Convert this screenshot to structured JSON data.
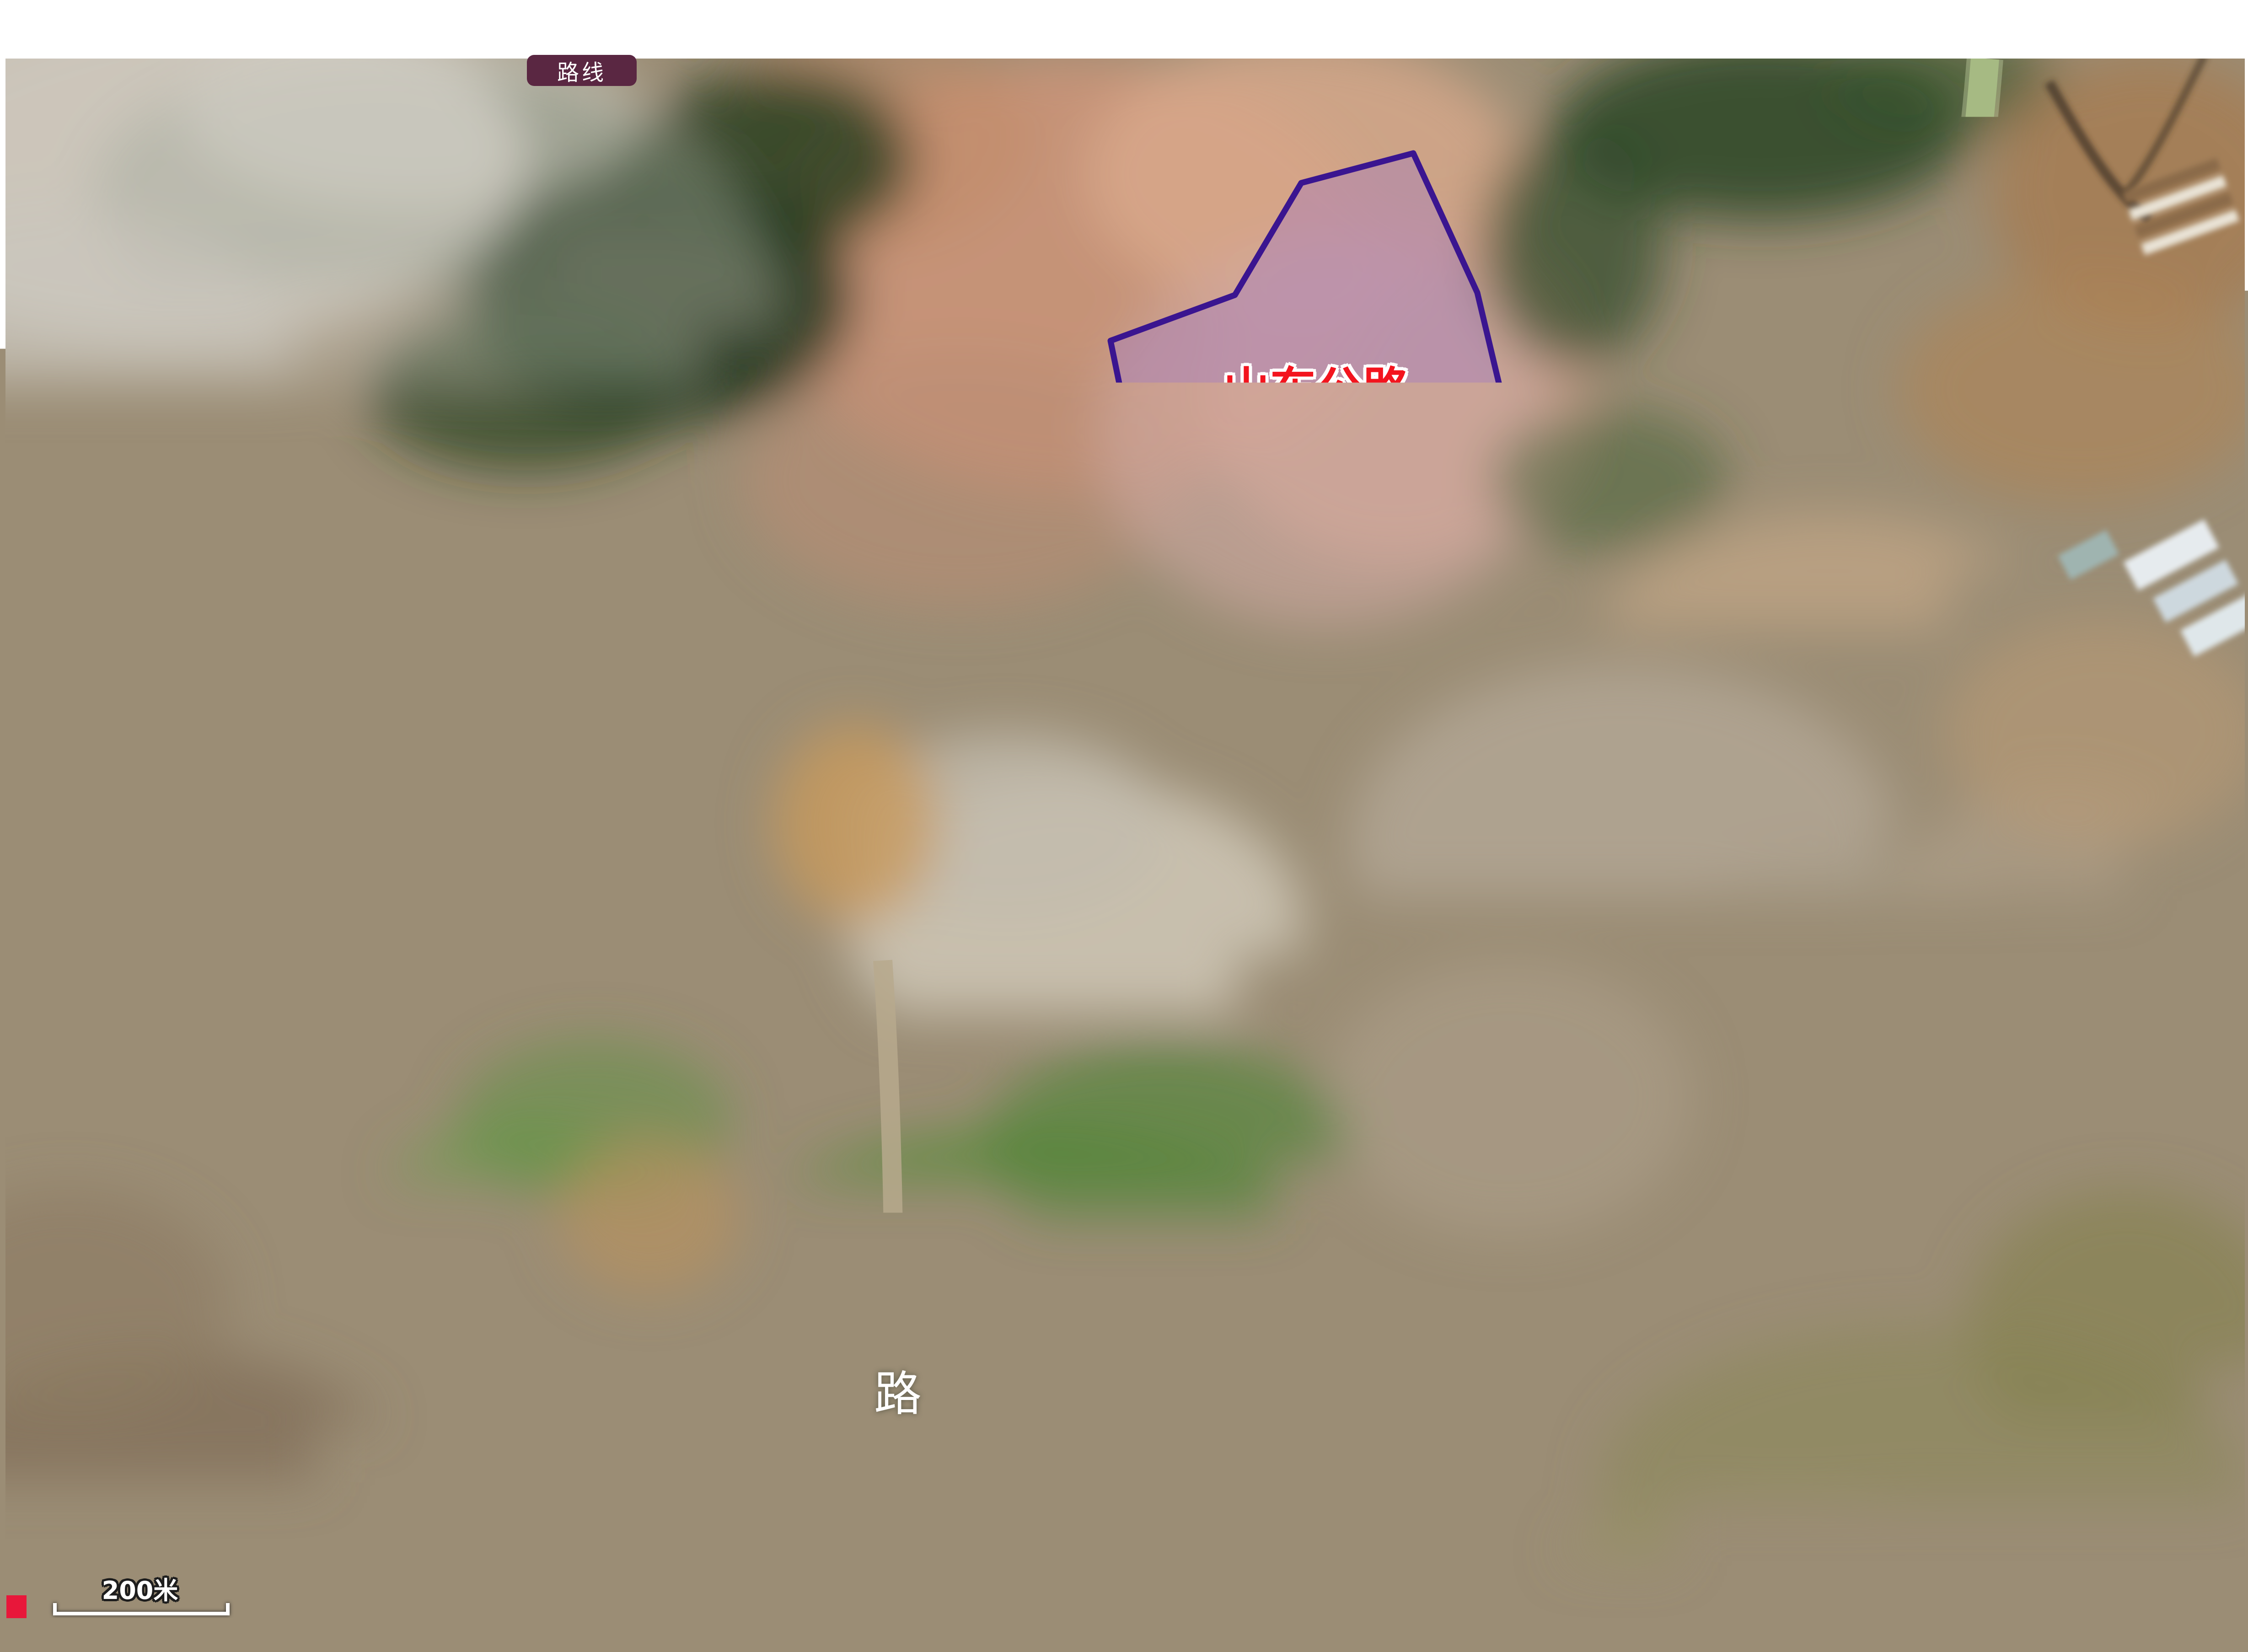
{
  "toolbar": {
    "route_button_label": "路线"
  },
  "labels": {
    "jishi_line1": "山东公路",
    "jishi_line2": "技师学院",
    "xinhang_line1": "山东新航实验",
    "xinhang_line2": "外国语学校",
    "guanliju_line1": "历城区公路管理局",
    "guanliju_line2": "彩石公路管理站",
    "qinghe": "清河太夫人墓",
    "yiliao": "医疗器械创新和监管服务大平台",
    "shipin": "食品药品创新和监管服务大平台"
  },
  "roads": {
    "jingshidong": [
      "经",
      "十",
      "东",
      "路"
    ],
    "cailong": [
      "彩",
      "龙",
      "路"
    ]
  },
  "scale": {
    "label": "200米"
  },
  "colors": {
    "annotation_red": "#f50f1e",
    "annotation_yellow": "#f2d50a",
    "annotation_purple": "#3a1590",
    "purple_fill": "rgba(160,120,195,0.40)",
    "yellow_fill": "rgba(235,185,50,0.42)",
    "red_text": "#f3141e",
    "white_text": "#ffffff",
    "route_button_bg": "#5a2742"
  },
  "polygons": {
    "xinhang": "30,1195 345,1118 410,1228 880,1452 862,1630 795,1780 638,1975 350,1930 90,1820 28,1590",
    "jishi": "3090,335 2845,400 2700,645 2428,745 2468,940 2575,1160 2650,1505 3012,1348 3348,1135 3230,640",
    "guanlizhan": "1728,1608 2040,1532 1992,1902 1798,2060 1692,1958",
    "qinghe": "1250,2526 1580,2494 1594,2788 1262,2836",
    "yiliao_parcel": "1235,2330 1392,2282 1572,2218 1800,2135 1930,2088 1968,2112 1960,2445 1700,2488 1450,2512 1255,2515",
    "small_parcel": "1602,2568 1948,2505 1956,2618 1788,2624 1788,2836 1602,2840",
    "shipin_parcel": "2758,1975 2998,2210 2880,2398 2758,2575 2600,2690 2442,2738 2350,2735 2390,2392"
  },
  "lines": {
    "yiliao_leader": "225,3052 1790,3052 1790,2838",
    "shipin_leader": "2442,2740 2442,3026 3895,3026",
    "scale_bar": "120,3505 120,3528 498,3528 498,3505"
  }
}
